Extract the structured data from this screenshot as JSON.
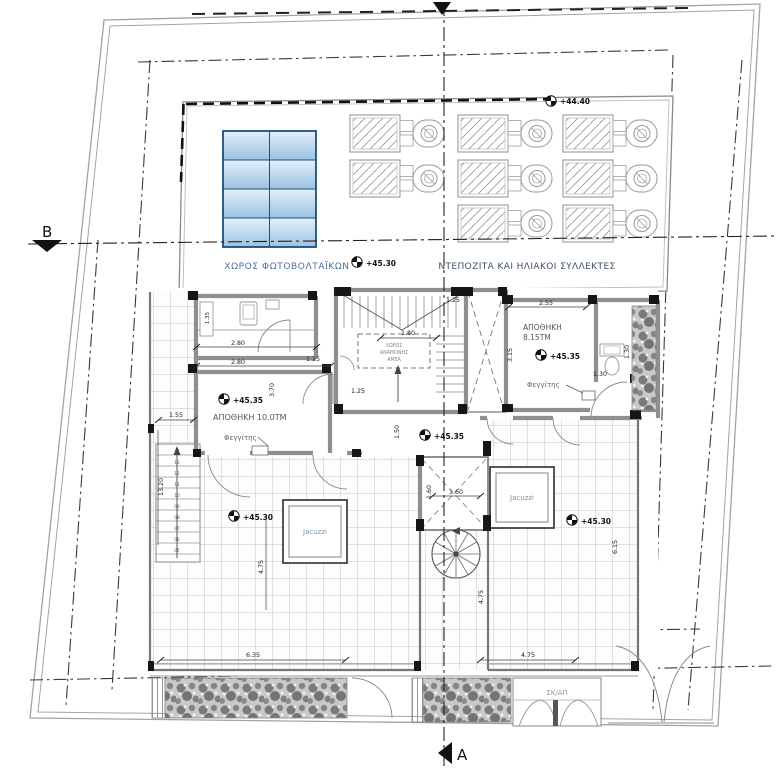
{
  "plan": {
    "area_labels": {
      "photovoltaic": "ΧΩΡΟΣ ΦΩΤΟΒΟΛΤΑΪΚΩΝ",
      "solar_collectors": "ΝΤΕΠΟΖΙΤΑ ΚΑΙ ΗΛΙΑΚΟΙ ΣΥΛΛΕΚΤΕΣ",
      "storage_left": "ΑΠΟΘΗΚΗ 10.0ΤΜ",
      "storage_right_name": "ΑΠΟΘΗΚΗ",
      "storage_right_area": "8.15ΤΜ",
      "skylight_left": "Φεγγίτης",
      "skylight_right": "Φεγγίτης",
      "jacuzzi_left": "Jacuzzi",
      "jacuzzi_right": "Jacuzzi",
      "stair_store": "ΣΚ/ΑΠ",
      "amea_line1": "ΧΩΡΟΣ",
      "amea_line2": "ΑΝΑΜΟΝΗΣ",
      "amea_line3": "ΑΜΕΑ"
    },
    "elevation_markers": {
      "roof_high": "+44.40",
      "pv_level": "+45.30",
      "storage_left_level": "+45.35",
      "storage_right_level": "+45.35",
      "corridor_level": "+45.35",
      "terrace_left_level": "+45.30",
      "terrace_right_level": "+45.30"
    },
    "sections": {
      "a": "A",
      "b": "B"
    },
    "dimensions": {
      "d280": "2.80",
      "d125": "1.25",
      "d370": "3.70",
      "d135": "1.35",
      "d180": "1.80",
      "d150": "1.50",
      "d255": "2.55",
      "d130": "1.30",
      "d315": "3.15",
      "d160": "1.60",
      "d1320": "13.20",
      "d155": "1.55",
      "d475": "4.75",
      "d635": "6.35",
      "d615": "6.15"
    },
    "stair_numbers": [
      "14",
      "13",
      "12",
      "11",
      "10",
      "09",
      "08",
      "07",
      "06",
      "05"
    ]
  },
  "colors": {
    "pv_border": "#1d4e7a",
    "pv_light": "#e2f0fb",
    "pv_dark": "#9cc2e2",
    "label_blue": "#4a6f9d",
    "label_dark": "#3d5066",
    "wall_gray": "#8f8f8f"
  }
}
